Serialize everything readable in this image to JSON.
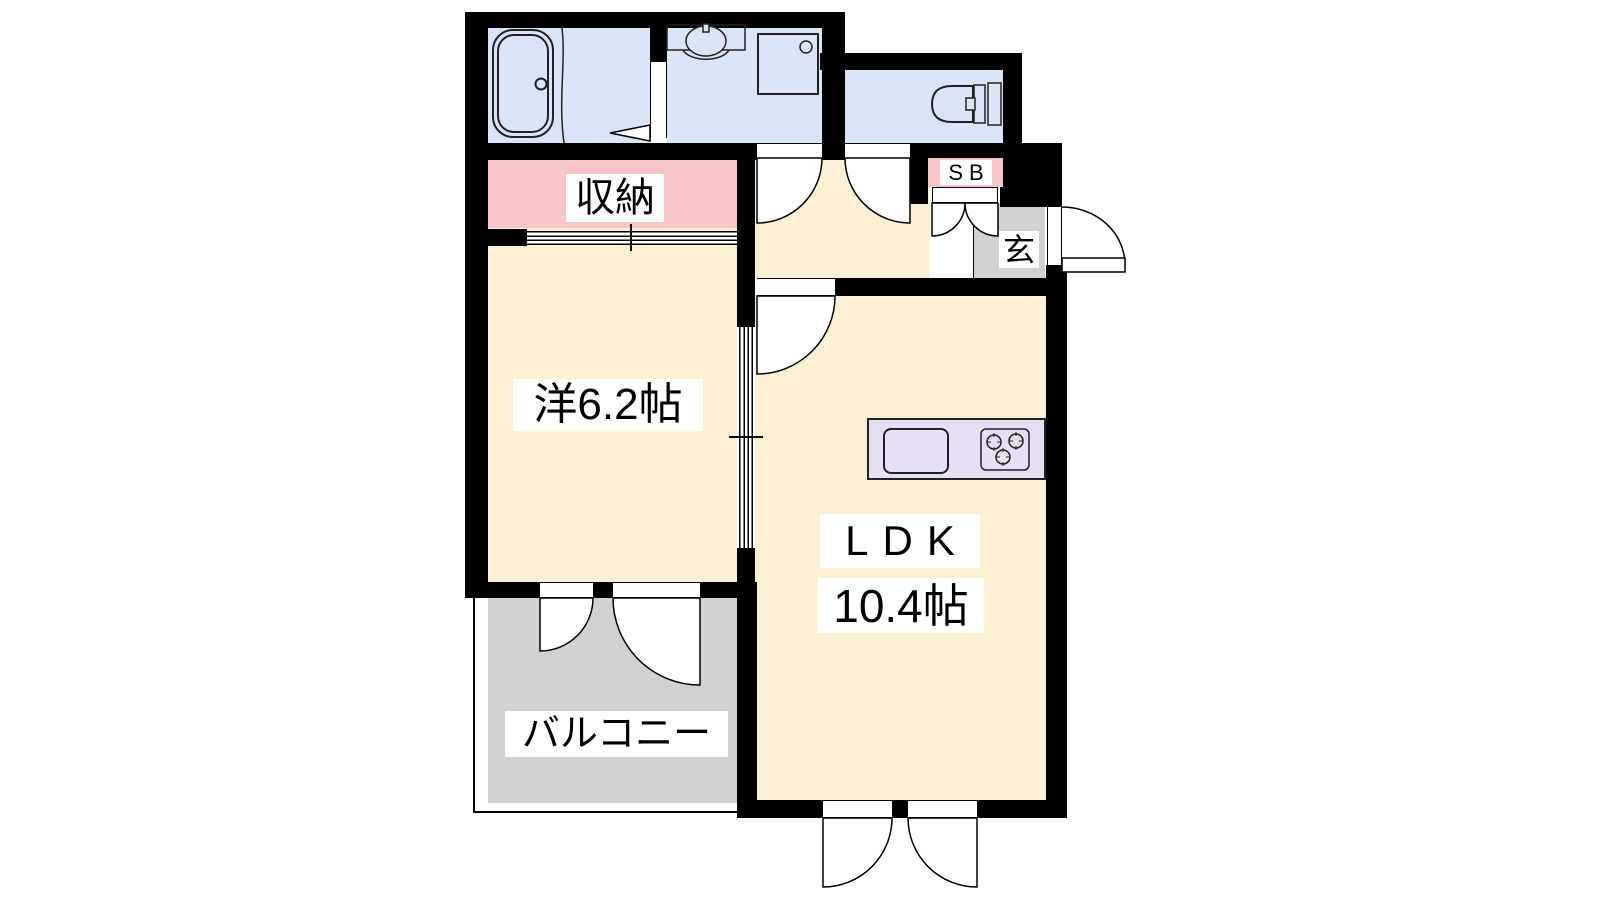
{
  "plan": {
    "rooms": {
      "storage": {
        "label": "収納"
      },
      "western_room": {
        "label": "洋6.2帖"
      },
      "ldk": {
        "label": "LDK",
        "size": "10.4帖"
      },
      "balcony": {
        "label": "バルコニー"
      },
      "entrance": {
        "label": "玄"
      },
      "shoe_box": {
        "label": "SB"
      }
    },
    "colors": {
      "wall": "#000000",
      "room_floor": "#FBF0D3",
      "wet_area_floor": "#D9E5F6",
      "storage_fill": "#F8C5C8",
      "balcony_floor": "#D1D1D1",
      "entrance_floor": "#D1D1D1",
      "kitchen_counter": "#E6DEF4",
      "label_background": "#FFFFFF",
      "label_text": "#000000"
    },
    "fixtures": [
      "bathtub",
      "vanity-sink",
      "washing-machine-pan",
      "toilet",
      "kitchen-sink",
      "gas-stove",
      "shoe-box-doors",
      "sliding-closet-doors",
      "sliding-partition"
    ]
  }
}
